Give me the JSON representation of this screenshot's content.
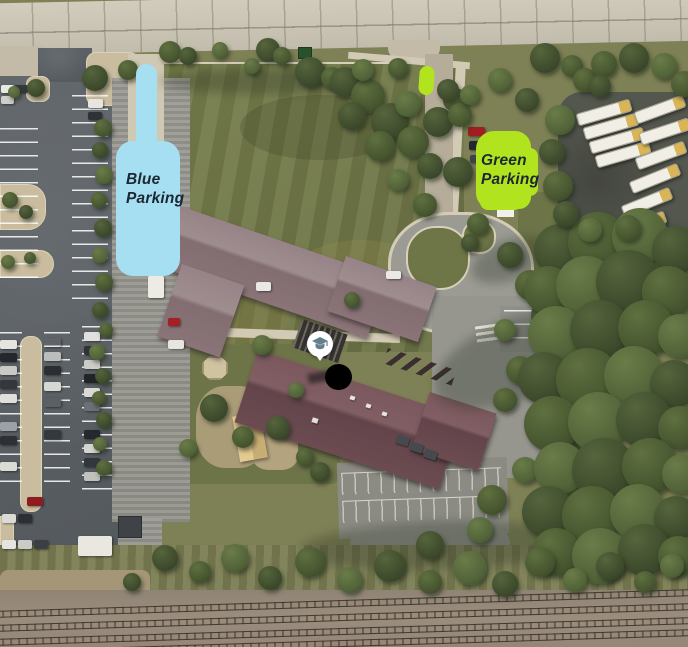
{
  "annotations": {
    "blue_zone": {
      "line1": "Blue",
      "line2": "Parking",
      "fill": "#a6dff2",
      "text_color": "#1c2733"
    },
    "green_zone": {
      "line1": "Green",
      "line2": "Parking",
      "fill": "#b2e31f",
      "text_color": "#1e2a1c"
    },
    "small_green_marker": {
      "fill": "#b2e31f"
    },
    "school_marker": {
      "icon": "graduation-cap-icon",
      "bg": "#ffffff",
      "glyph_color": "#64808d"
    },
    "redaction_dot": {
      "fill": "#000000"
    }
  }
}
